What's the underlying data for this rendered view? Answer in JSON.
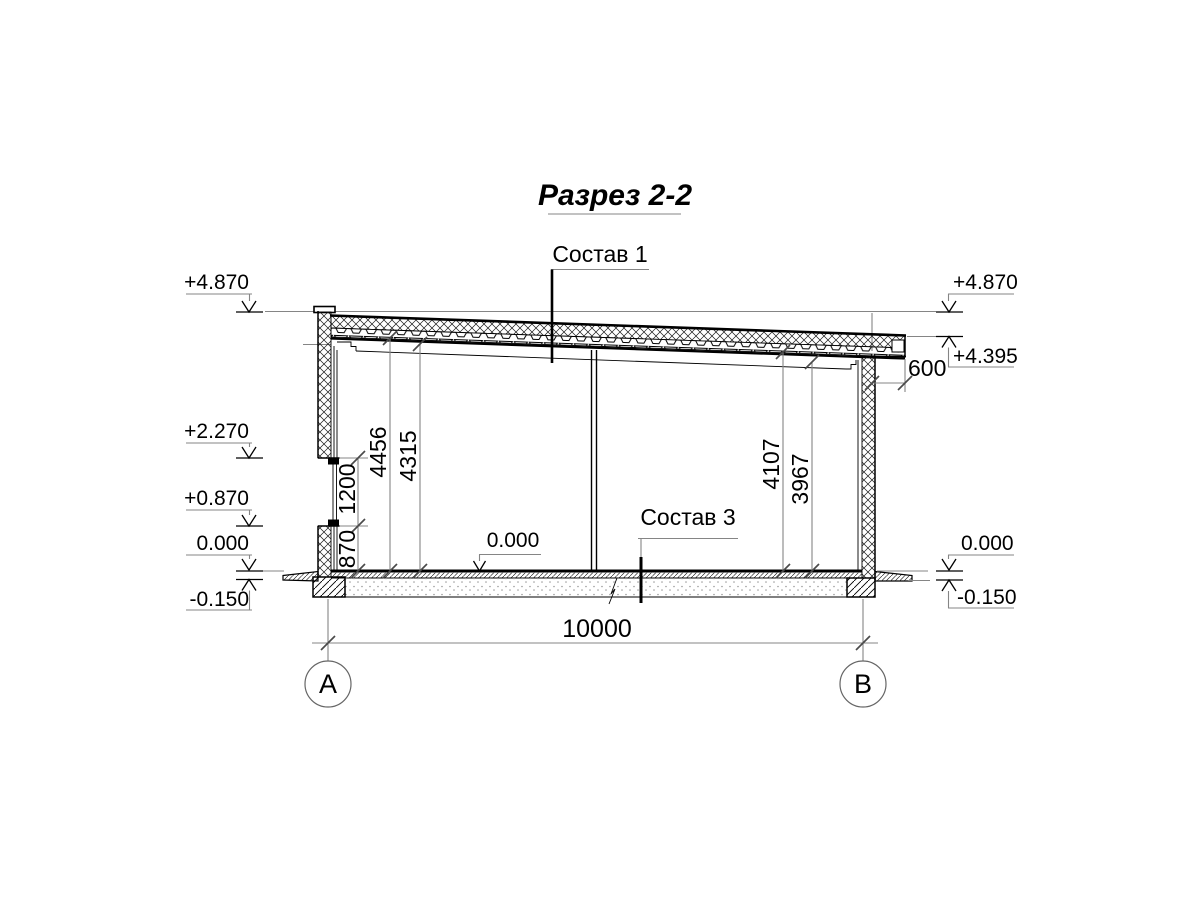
{
  "title": "Разрез 2-2",
  "callouts": {
    "roof_composition": "Состав 1",
    "floor_composition": "Состав 3",
    "floor_level": "0.000"
  },
  "elevations": {
    "left": [
      "+4.870",
      "+2.270",
      "+0.870",
      "0.000",
      "-0.150"
    ],
    "right": [
      "+4.870",
      "+4.395",
      "0.000",
      "-0.150"
    ]
  },
  "dimensions": {
    "window_chain": [
      "870",
      "1200"
    ],
    "left_heights": [
      "4456",
      "4315"
    ],
    "right_heights": [
      "4107",
      "3967"
    ],
    "eave_overhang": "600",
    "overall_width": "10000"
  },
  "axes": {
    "left": "А",
    "right": "В"
  },
  "colors": {
    "line": "#000000",
    "dim_line": "#858585",
    "background": "#ffffff"
  }
}
